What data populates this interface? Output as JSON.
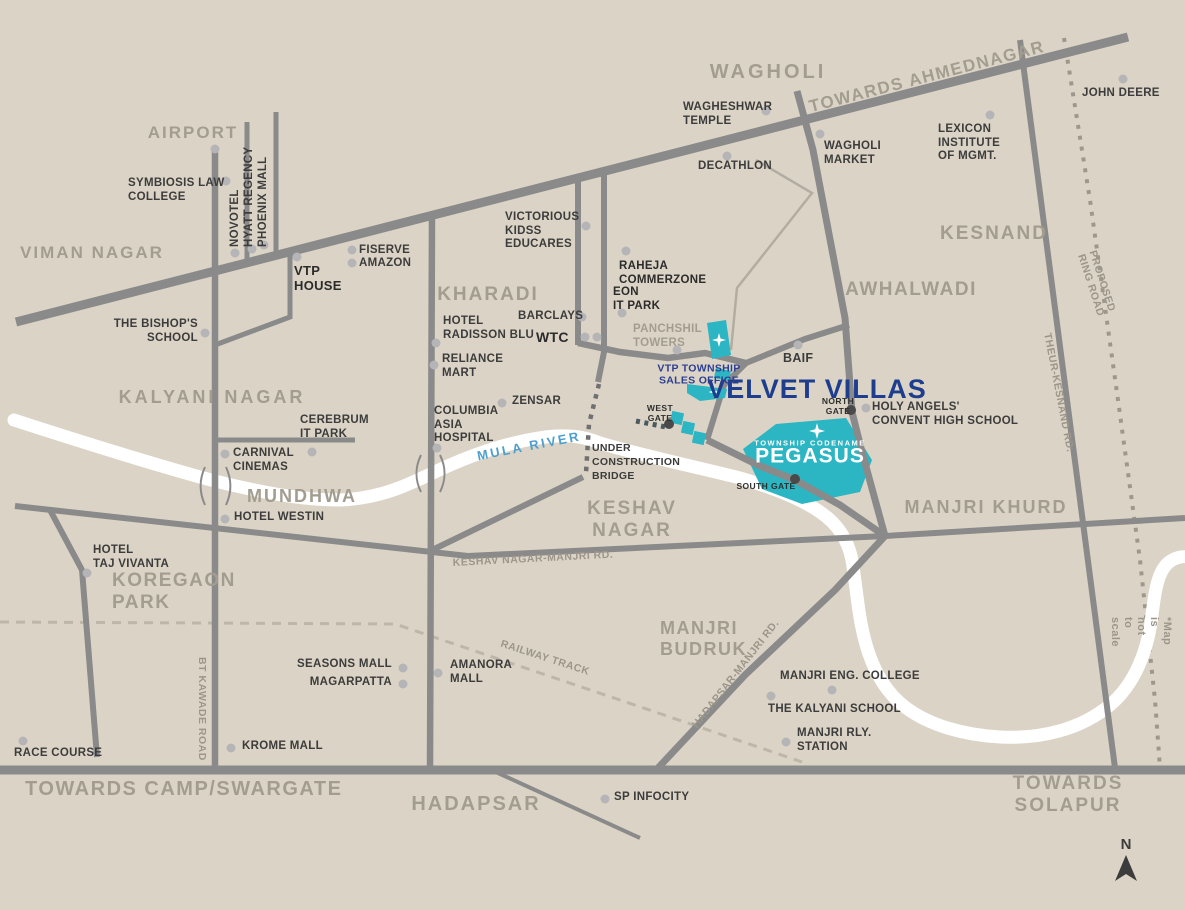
{
  "map": {
    "title": "Velvet Villas township location map",
    "colors": {
      "background": "#DBD4C6",
      "road": "#8A8A8A",
      "river": "#FFFFFF",
      "teal_township": "#2CB5C3",
      "navy_brand": "#1E3D8E",
      "navy_small": "#2C3E92",
      "area_label_gray": "#A39D90",
      "place_text": "#3C3C3C",
      "road_label_gray": "#9C968A",
      "river_label_blue": "#4E9FCE",
      "railway_dash": "#BDB7AA",
      "marker_dot": "#B5B5B8",
      "gate_dot": "#4A4A4A"
    },
    "compass": {
      "letter": "N"
    },
    "labels": [
      {
        "id": "label-viman-nagar",
        "text": "VIMAN NAGAR",
        "x": 92,
        "y": 243,
        "cls": "area",
        "anchor": "tc",
        "size": 17,
        "ls": 2
      },
      {
        "id": "label-airport",
        "text": "AIRPORT",
        "x": 193,
        "y": 123,
        "cls": "area",
        "anchor": "tc",
        "size": 17,
        "ls": 2
      },
      {
        "id": "label-wagholi",
        "text": "WAGHOLI",
        "x": 768,
        "y": 61,
        "cls": "area",
        "anchor": "tc",
        "size": 20,
        "ls": 3
      },
      {
        "id": "label-towards-ahmednagar",
        "text": "TOWARDS AHMEDNAGAR",
        "x": 927,
        "y": 77,
        "cls": "area",
        "anchor": "cc",
        "rot": -14.5,
        "size": 17,
        "ls": 1.5
      },
      {
        "id": "label-kesnand",
        "text": "KESNAND",
        "x": 994,
        "y": 223,
        "cls": "area",
        "anchor": "tc",
        "size": 19,
        "ls": 2
      },
      {
        "id": "label-awhalwadi",
        "text": "AWHALWADI",
        "x": 911,
        "y": 279,
        "cls": "area",
        "anchor": "tc",
        "size": 19,
        "ls": 1.5
      },
      {
        "id": "label-kharadi",
        "text": "KHARADI",
        "x": 488,
        "y": 284,
        "cls": "area",
        "anchor": "tc",
        "size": 19,
        "ls": 2
      },
      {
        "id": "label-kalyani-nagar",
        "text": "KALYANI NAGAR",
        "x": 212,
        "y": 387,
        "cls": "area",
        "anchor": "tc",
        "size": 18,
        "ls": 3
      },
      {
        "id": "label-keshav-nagar",
        "text": "KESHAV\nNAGAR",
        "x": 632,
        "y": 498,
        "cls": "area",
        "anchor": "tc",
        "size": 19,
        "ls": 2
      },
      {
        "id": "label-manjri-khurd",
        "text": "MANJRI KHURD",
        "x": 986,
        "y": 497,
        "cls": "area",
        "anchor": "tc",
        "size": 18,
        "ls": 2
      },
      {
        "id": "label-mundhwa",
        "text": "MUNDHWA",
        "x": 302,
        "y": 486,
        "cls": "area",
        "anchor": "tc",
        "size": 18,
        "ls": 2
      },
      {
        "id": "label-koregaon-park",
        "text": "KOREGAON\nPARK",
        "x": 112,
        "y": 570,
        "cls": "area",
        "anchor": "tl",
        "size": 19,
        "ls": 1.5
      },
      {
        "id": "label-manjri-budruk",
        "text": "MANJRI\nBUDRUK",
        "x": 660,
        "y": 618,
        "cls": "area",
        "anchor": "tl",
        "size": 18,
        "ls": 1.5
      },
      {
        "id": "label-hadapsar",
        "text": "HADAPSAR",
        "x": 476,
        "y": 793,
        "cls": "area",
        "anchor": "tc",
        "size": 20,
        "ls": 2
      },
      {
        "id": "label-towards-camp",
        "text": "TOWARDS CAMP/SWARGATE",
        "x": 25,
        "y": 778,
        "cls": "area",
        "anchor": "tl",
        "size": 20,
        "ls": 1.5
      },
      {
        "id": "label-towards-solapur",
        "text": "TOWARDS  SOLAPUR",
        "x": 1068,
        "y": 773,
        "cls": "area",
        "anchor": "tc",
        "size": 19,
        "ls": 2
      },
      {
        "id": "label-symbiosis-law-college",
        "text": "SYMBIOSIS LAW\nCOLLEGE",
        "x": 128,
        "y": 177,
        "anchor": "tl"
      },
      {
        "id": "label-novotel",
        "text": "NOVOTEL",
        "x": 229,
        "y": 247,
        "anchor": "tl",
        "rot": -90
      },
      {
        "id": "label-hyatt-regency",
        "text": "HYATT REGENCY",
        "x": 243,
        "y": 247,
        "anchor": "tl",
        "rot": -90
      },
      {
        "id": "label-phoenix-mall",
        "text": "PHOENIX MALL",
        "x": 257,
        "y": 247,
        "anchor": "tl",
        "rot": -90
      },
      {
        "id": "label-vtp-house",
        "text": "VTP\nHOUSE",
        "x": 294,
        "y": 263,
        "cls": "place-bold",
        "anchor": "tl",
        "size": 13
      },
      {
        "id": "label-fiserve",
        "text": "FISERVE",
        "x": 359,
        "y": 244,
        "anchor": "tl"
      },
      {
        "id": "label-amazon",
        "text": "AMAZON",
        "x": 359,
        "y": 257,
        "anchor": "tl"
      },
      {
        "id": "label-bishops-school",
        "text": "THE BISHOP'S\nSCHOOL",
        "x": 198,
        "y": 318,
        "anchor": "tr"
      },
      {
        "id": "label-wagheshwar-temple",
        "text": "WAGHESHWAR\nTEMPLE",
        "x": 683,
        "y": 101,
        "anchor": "tl"
      },
      {
        "id": "label-decathlon",
        "text": "DECATHLON",
        "x": 698,
        "y": 160,
        "anchor": "tl"
      },
      {
        "id": "label-wagholi-market",
        "text": "WAGHOLI\nMARKET",
        "x": 824,
        "y": 140,
        "anchor": "tl"
      },
      {
        "id": "label-lexicon-institute",
        "text": "LEXICON\nINSTITUTE\nOF MGMT.",
        "x": 938,
        "y": 123,
        "anchor": "tl"
      },
      {
        "id": "label-john-deere",
        "text": "JOHN DEERE",
        "x": 1082,
        "y": 87,
        "anchor": "tl"
      },
      {
        "id": "label-victorious-kidss",
        "text": "VICTORIOUS\nKIDSS\nEDUCARES",
        "x": 505,
        "y": 211,
        "anchor": "tl"
      },
      {
        "id": "label-raheja-commerzone",
        "text": "RAHEJA\nCOMMERZONE",
        "x": 619,
        "y": 260,
        "cls": "place-bold",
        "anchor": "tl"
      },
      {
        "id": "label-eon-it-park",
        "text": "EON\nIT PARK",
        "x": 613,
        "y": 286,
        "cls": "place-bold",
        "anchor": "tl"
      },
      {
        "id": "label-panchshil-towers",
        "text": "PANCHSHIL\nTOWERS",
        "x": 633,
        "y": 323,
        "cls": "panchshil",
        "anchor": "tl"
      },
      {
        "id": "label-barclays",
        "text": "BARCLAYS",
        "x": 518,
        "y": 310,
        "anchor": "tl"
      },
      {
        "id": "label-wtc",
        "text": "WTC",
        "x": 536,
        "y": 329,
        "cls": "place-bold",
        "anchor": "tl",
        "size": 14
      },
      {
        "id": "label-hotel-radisson-blu",
        "text": "HOTEL\nRADISSON BLU",
        "x": 443,
        "y": 315,
        "anchor": "tl"
      },
      {
        "id": "label-reliance-mart",
        "text": "RELIANCE\nMART",
        "x": 442,
        "y": 353,
        "anchor": "tl"
      },
      {
        "id": "label-zensar",
        "text": "ZENSAR",
        "x": 512,
        "y": 395,
        "anchor": "tl"
      },
      {
        "id": "label-columbia-asia-hospital",
        "text": "COLUMBIA\nASIA\nHOSPITAL",
        "x": 434,
        "y": 405,
        "anchor": "tl"
      },
      {
        "id": "label-cerebrum-it-park",
        "text": "CEREBRUM\nIT PARK",
        "x": 300,
        "y": 414,
        "anchor": "tl"
      },
      {
        "id": "label-carnival-cinemas",
        "text": "CARNIVAL\nCINEMAS",
        "x": 233,
        "y": 447,
        "anchor": "tl"
      },
      {
        "id": "label-hotel-westin",
        "text": "HOTEL WESTIN",
        "x": 234,
        "y": 511,
        "anchor": "tl"
      },
      {
        "id": "label-hotel-taj-vivanta",
        "text": "HOTEL\nTAJ VIVANTA",
        "x": 93,
        "y": 544,
        "anchor": "tl"
      },
      {
        "id": "label-race-course",
        "text": "RACE COURSE",
        "x": 14,
        "y": 747,
        "anchor": "tl"
      },
      {
        "id": "label-krome-mall",
        "text": "KROME MALL",
        "x": 242,
        "y": 740,
        "anchor": "tl"
      },
      {
        "id": "label-seasons-mall",
        "text": "SEASONS MALL",
        "x": 392,
        "y": 658,
        "anchor": "tr"
      },
      {
        "id": "label-magarpatta",
        "text": "MAGARPATTA",
        "x": 392,
        "y": 676,
        "anchor": "tr"
      },
      {
        "id": "label-amanora-mall",
        "text": "AMANORA\nMALL",
        "x": 450,
        "y": 659,
        "anchor": "tl"
      },
      {
        "id": "label-sp-infocity",
        "text": "SP INFOCITY",
        "x": 614,
        "y": 791,
        "anchor": "tl"
      },
      {
        "id": "label-manjri-eng-college",
        "text": "MANJRI ENG. COLLEGE",
        "x": 780,
        "y": 670,
        "anchor": "tl"
      },
      {
        "id": "label-kalyani-school",
        "text": "THE KALYANI SCHOOL",
        "x": 768,
        "y": 703,
        "anchor": "tl"
      },
      {
        "id": "label-manjri-rly-station",
        "text": "MANJRI RLY.\nSTATION",
        "x": 797,
        "y": 727,
        "anchor": "tl"
      },
      {
        "id": "label-holy-angels",
        "text": "HOLY ANGELS'\nCONVENT HIGH SCHOOL",
        "x": 872,
        "y": 401,
        "anchor": "tl"
      },
      {
        "id": "label-baif",
        "text": "BAIF",
        "x": 783,
        "y": 351,
        "anchor": "tl",
        "size": 12.5
      },
      {
        "id": "label-under-construction-bridge",
        "text": "UNDER\nCONSTRUCTION\nBRIDGE",
        "x": 592,
        "y": 441,
        "anchor": "tl",
        "size": 10.5,
        "lh": 1.35
      },
      {
        "id": "label-west-gate",
        "text": "WEST\nGATE",
        "x": 660,
        "y": 403,
        "cls": "gate",
        "anchor": "tc"
      },
      {
        "id": "label-north-gate",
        "text": "NORTH\nGATE",
        "x": 838,
        "y": 396,
        "cls": "gate",
        "anchor": "tc"
      },
      {
        "id": "label-south-gate",
        "text": "SOUTH GATE",
        "x": 766,
        "y": 481,
        "cls": "gate",
        "anchor": "tc"
      },
      {
        "id": "label-keshav-nagar-manjri-rd",
        "text": "KESHAV NAGAR-MANJRI RD.",
        "x": 533,
        "y": 559,
        "cls": "road",
        "anchor": "cc",
        "rot": -3
      },
      {
        "id": "label-bt-kawade-road",
        "text": "BT KAWADE ROAD",
        "x": 208,
        "y": 657,
        "cls": "road",
        "anchor": "tl",
        "rot": 90
      },
      {
        "id": "label-hadapsar-manjri-rd",
        "text": "HADAPSAR-MANJRI RD.",
        "x": 736,
        "y": 674,
        "cls": "road",
        "anchor": "cc",
        "rot": -52
      },
      {
        "id": "label-theur-kesnand-rd",
        "text": "THEUR-KESNAND RD.",
        "x": 1053,
        "y": 332,
        "cls": "road",
        "anchor": "tl",
        "rot": 79
      },
      {
        "id": "label-railway-track",
        "text": "RAILWAY TRACK",
        "x": 545,
        "y": 658,
        "cls": "road",
        "anchor": "cc",
        "rot": 18
      },
      {
        "id": "label-proposed-ring-road",
        "text": "PROPOSED RING ROAD",
        "x": 1098,
        "y": 249,
        "cls": "road",
        "anchor": "tl",
        "rot": 72
      },
      {
        "id": "label-map-not-to-scale",
        "text": "*Map is not to scale",
        "x": 1173,
        "y": 617,
        "cls": "road",
        "anchor": "tl",
        "rot": 90,
        "size": 11
      },
      {
        "id": "label-velvet-villas",
        "text": "VELVET VILLAS",
        "x": 817,
        "y": 390,
        "cls": "navy-big",
        "anchor": "cc",
        "size": 27,
        "ls": 1
      },
      {
        "id": "label-vtp-township-sales-office",
        "text": "VTP TOWNSHIP\nSALES OFFICE",
        "x": 699,
        "y": 375,
        "cls": "navy-small",
        "anchor": "cc",
        "size": 10.5
      },
      {
        "id": "label-mula-river",
        "text": "MULA RIVER",
        "x": 529,
        "y": 446,
        "cls": "mula",
        "anchor": "cc",
        "rot": -11,
        "size": 13,
        "ls": 2.5
      },
      {
        "id": "label-township-codename",
        "text": "TOWNSHIP CODENAME",
        "x": 810,
        "y": 444,
        "cls": "pegasus-sub",
        "anchor": "cc",
        "size": 7.5,
        "ls": 1.5
      },
      {
        "id": "label-pegasus",
        "text": "PEGASUS",
        "x": 810,
        "y": 457,
        "cls": "pegasus-big",
        "anchor": "cc",
        "size": 21,
        "ls": 1
      }
    ],
    "dots": [
      {
        "id": "dot-airport",
        "x": 215,
        "y": 149
      },
      {
        "id": "dot-symbiosis",
        "x": 226,
        "y": 181
      },
      {
        "id": "dot-novotel",
        "x": 235,
        "y": 253
      },
      {
        "id": "dot-hyatt",
        "x": 252,
        "y": 249
      },
      {
        "id": "dot-phoenix",
        "x": 264,
        "y": 245
      },
      {
        "id": "dot-vtp-house",
        "x": 297,
        "y": 257
      },
      {
        "id": "dot-fiserve",
        "x": 352,
        "y": 250
      },
      {
        "id": "dot-amazon",
        "x": 352,
        "y": 263
      },
      {
        "id": "dot-bishops",
        "x": 205,
        "y": 333
      },
      {
        "id": "dot-wagheshwar",
        "x": 766,
        "y": 111
      },
      {
        "id": "dot-decathlon",
        "x": 727,
        "y": 156
      },
      {
        "id": "dot-wagholi-market",
        "x": 820,
        "y": 134
      },
      {
        "id": "dot-lexicon",
        "x": 990,
        "y": 115
      },
      {
        "id": "dot-john-deere",
        "x": 1123,
        "y": 79
      },
      {
        "id": "dot-victorious",
        "x": 586,
        "y": 226
      },
      {
        "id": "dot-raheja",
        "x": 626,
        "y": 251
      },
      {
        "id": "dot-eon",
        "x": 622,
        "y": 313
      },
      {
        "id": "dot-panchshil",
        "x": 677,
        "y": 350
      },
      {
        "id": "dot-barclays",
        "x": 582,
        "y": 317
      },
      {
        "id": "dot-wtc-1",
        "x": 585,
        "y": 337
      },
      {
        "id": "dot-wtc-2",
        "x": 597,
        "y": 337
      },
      {
        "id": "dot-radisson",
        "x": 436,
        "y": 343
      },
      {
        "id": "dot-reliance",
        "x": 434,
        "y": 365
      },
      {
        "id": "dot-zensar",
        "x": 502,
        "y": 403
      },
      {
        "id": "dot-columbia",
        "x": 437,
        "y": 448
      },
      {
        "id": "dot-cerebrum",
        "x": 312,
        "y": 452
      },
      {
        "id": "dot-carnival",
        "x": 225,
        "y": 454
      },
      {
        "id": "dot-westin",
        "x": 225,
        "y": 519
      },
      {
        "id": "dot-taj-vivanta",
        "x": 87,
        "y": 573
      },
      {
        "id": "dot-race-course",
        "x": 23,
        "y": 741
      },
      {
        "id": "dot-krome",
        "x": 231,
        "y": 748
      },
      {
        "id": "dot-seasons",
        "x": 403,
        "y": 668
      },
      {
        "id": "dot-magarpatta",
        "x": 403,
        "y": 684
      },
      {
        "id": "dot-amanora",
        "x": 438,
        "y": 673
      },
      {
        "id": "dot-sp-infocity",
        "x": 605,
        "y": 799
      },
      {
        "id": "dot-manjri-eng",
        "x": 832,
        "y": 690
      },
      {
        "id": "dot-kalyani-school",
        "x": 771,
        "y": 696
      },
      {
        "id": "dot-manjri-rly",
        "x": 786,
        "y": 742
      },
      {
        "id": "dot-holy-angels",
        "x": 866,
        "y": 408
      },
      {
        "id": "dot-baif",
        "x": 798,
        "y": 345
      },
      {
        "id": "dot-west-gate",
        "x": 669,
        "y": 424,
        "type": "dark"
      },
      {
        "id": "dot-north-gate",
        "x": 851,
        "y": 410,
        "type": "dark"
      },
      {
        "id": "dot-south-gate",
        "x": 795,
        "y": 479,
        "type": "dark"
      }
    ],
    "stars": [
      {
        "id": "star-panchshil-plot",
        "x": 719,
        "y": 340,
        "s": 14
      },
      {
        "id": "star-sales-office",
        "x": 714,
        "y": 392,
        "s": 11
      },
      {
        "id": "star-pegasus",
        "x": 817,
        "y": 431,
        "s": 16
      }
    ]
  }
}
